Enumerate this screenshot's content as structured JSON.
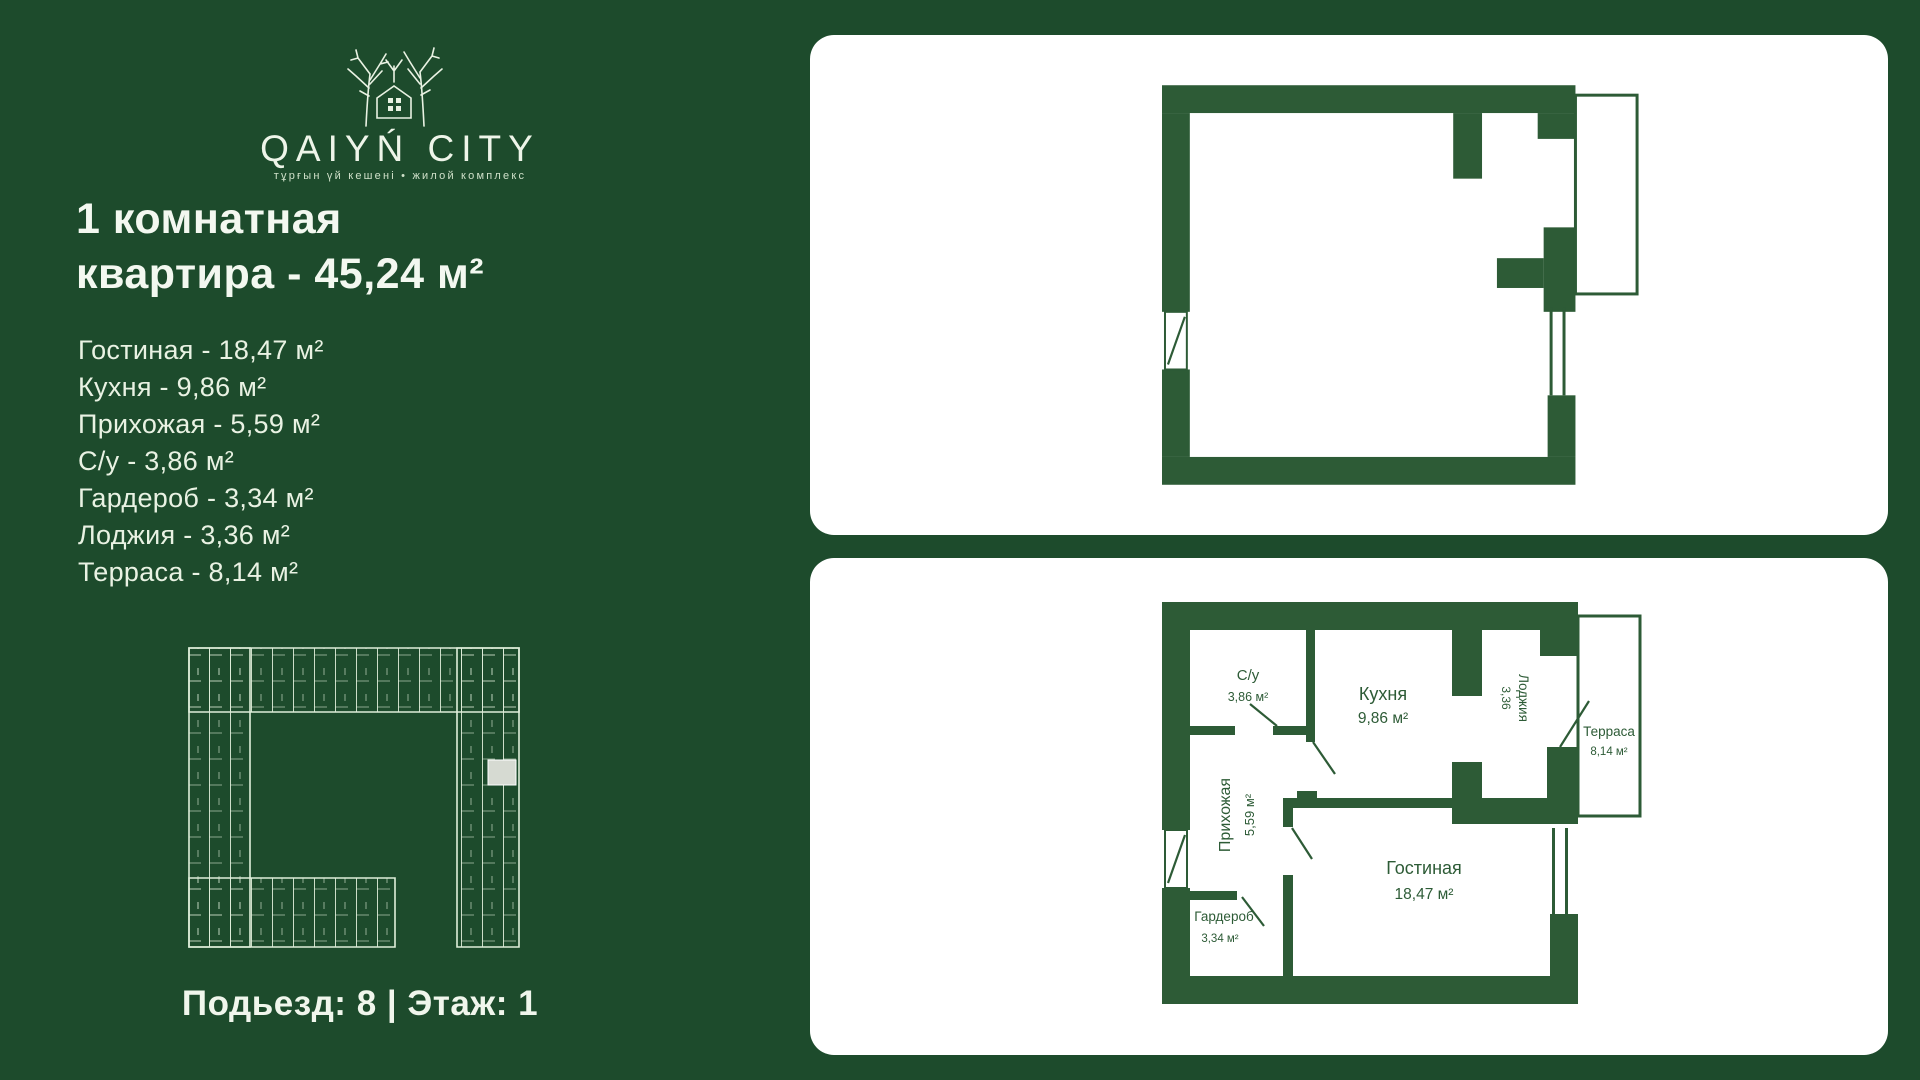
{
  "brand": {
    "name": "QAIYŃ CITY",
    "tagline": "тұрғын үй кешені  •  жилой комплекс"
  },
  "title": {
    "line1": "1 комнатная",
    "line2": "квартира - 45,24 м²"
  },
  "rooms": [
    {
      "label": "Гостиная -  18,47 м²"
    },
    {
      "label": "Кухня - 9,86 м²"
    },
    {
      "label": "Прихожая -  5,59 м²"
    },
    {
      "label": "С/у -  3,86 м²"
    },
    {
      "label": "Гардероб -  3,34 м²"
    },
    {
      "label": "Лоджия - 3,36 м²"
    },
    {
      "label": "Терраса - 8,14 м²"
    }
  ],
  "footer": "Подьезд: 8 | Этаж: 1",
  "plan_labels": {
    "syu": {
      "name": "С/у",
      "area": "3,86 м²"
    },
    "kitchen": {
      "name": "Кухня",
      "area": "9,86 м²"
    },
    "loggia": {
      "name": "Лоджия",
      "area": "3,36"
    },
    "terrace": {
      "name": "Терраса",
      "area": "8,14 м²"
    },
    "hall": {
      "name": "Прихожая",
      "area": "5,59 м²"
    },
    "wardrobe": {
      "name": "Гардероб",
      "area": "3,34 м²"
    },
    "living": {
      "name": "Гостиная",
      "area": "18,47 м²"
    }
  },
  "colors": {
    "background": "#1d4b2c",
    "wall_green": "#2d5b36",
    "cream_text": "#ecf4e6",
    "panel_white": "#ffffff",
    "minimap_lines": "#dfeeda",
    "highlight_unit": "#d6dad2"
  }
}
